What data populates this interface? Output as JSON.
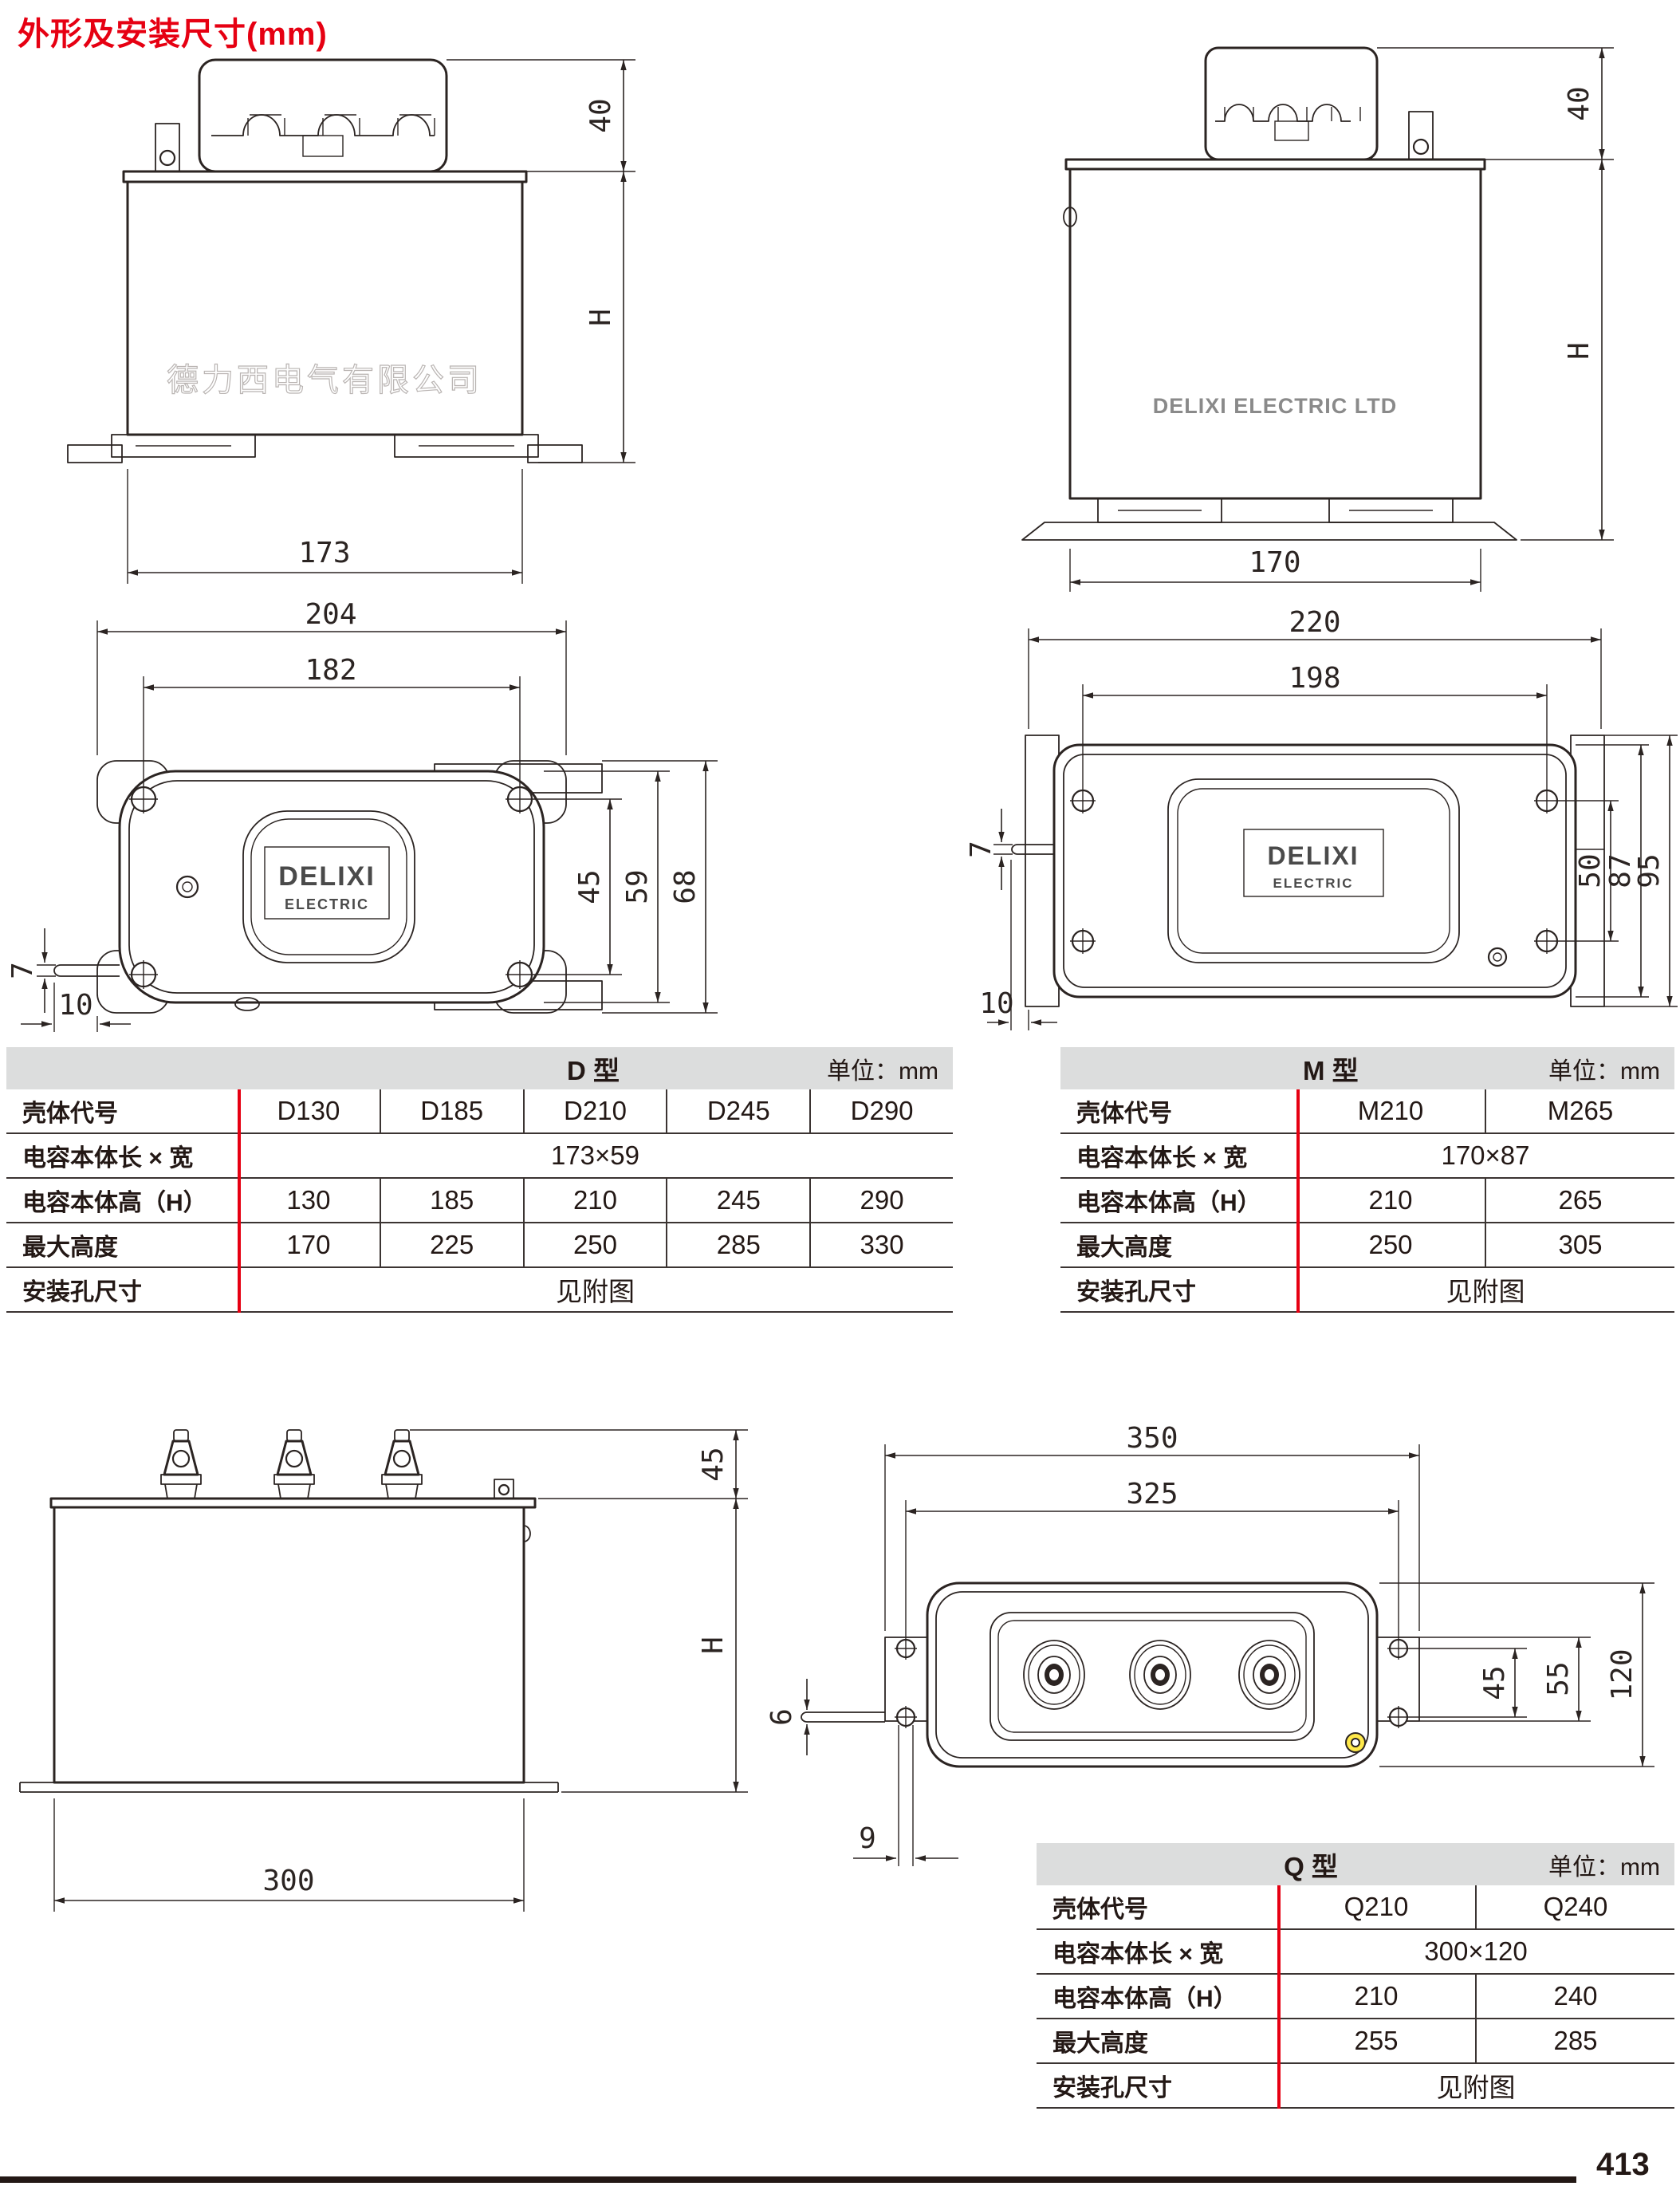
{
  "page": {
    "title": "外形及安装尺寸(mm)",
    "page_number": "413"
  },
  "branding": {
    "watermark_cn": "德力西电气有限公司",
    "brand_en": "DELIXI ELECTRIC LTD",
    "label_line1": "DELIXI",
    "label_line2": "ELECTRIC"
  },
  "drawings": {
    "d_front": {
      "dim_terminal_height": "40",
      "dim_height": "H",
      "dim_width": "173"
    },
    "m_front": {
      "dim_terminal_height": "40",
      "dim_height": "H",
      "dim_width": "170"
    },
    "d_top": {
      "dim_overall": "204",
      "dim_holes": "182",
      "dim_hole_v": "45",
      "dim_body_v": "59",
      "dim_overall_v": "68",
      "dim_lip": "7",
      "dim_offset": "10"
    },
    "m_top": {
      "dim_overall": "220",
      "dim_holes": "198",
      "dim_hole_v": "50",
      "dim_body_v": "87",
      "dim_overall_v": "95",
      "dim_lip": "7",
      "dim_offset": "10"
    },
    "q_front": {
      "dim_terminal_height": "45",
      "dim_height": "H",
      "dim_width": "300"
    },
    "q_top": {
      "dim_overall": "350",
      "dim_holes": "325",
      "dim_hole_v": "45",
      "dim_bracket_v": "55",
      "dim_overall_v": "120",
      "dim_pin": "6",
      "dim_offset": "9"
    }
  },
  "tables": {
    "d": {
      "type_label": "D 型",
      "unit_label": "单位：mm",
      "rows": [
        {
          "label": "壳体代号",
          "values": [
            "D130",
            "D185",
            "D210",
            "D245",
            "D290"
          ]
        },
        {
          "label": "电容本体长 × 宽",
          "merged": "173×59"
        },
        {
          "label": "电容本体高（H）",
          "values": [
            "130",
            "185",
            "210",
            "245",
            "290"
          ]
        },
        {
          "label": "最大高度",
          "values": [
            "170",
            "225",
            "250",
            "285",
            "330"
          ]
        },
        {
          "label": "安装孔尺寸",
          "merged": "见附图"
        }
      ]
    },
    "m": {
      "type_label": "M 型",
      "unit_label": "单位：mm",
      "rows": [
        {
          "label": "壳体代号",
          "values": [
            "M210",
            "M265"
          ]
        },
        {
          "label": "电容本体长 × 宽",
          "merged": "170×87"
        },
        {
          "label": "电容本体高（H）",
          "values": [
            "210",
            "265"
          ]
        },
        {
          "label": "最大高度",
          "values": [
            "250",
            "305"
          ]
        },
        {
          "label": "安装孔尺寸",
          "merged": "见附图"
        }
      ]
    },
    "q": {
      "type_label": "Q 型",
      "unit_label": "单位：mm",
      "rows": [
        {
          "label": "壳体代号",
          "values": [
            "Q210",
            "Q240"
          ]
        },
        {
          "label": "电容本体长 × 宽",
          "merged": "300×120"
        },
        {
          "label": "电容本体高（H）",
          "values": [
            "210",
            "240"
          ]
        },
        {
          "label": "最大高度",
          "values": [
            "255",
            "285"
          ]
        },
        {
          "label": "安装孔尺寸",
          "merged": "见附图"
        }
      ]
    }
  }
}
